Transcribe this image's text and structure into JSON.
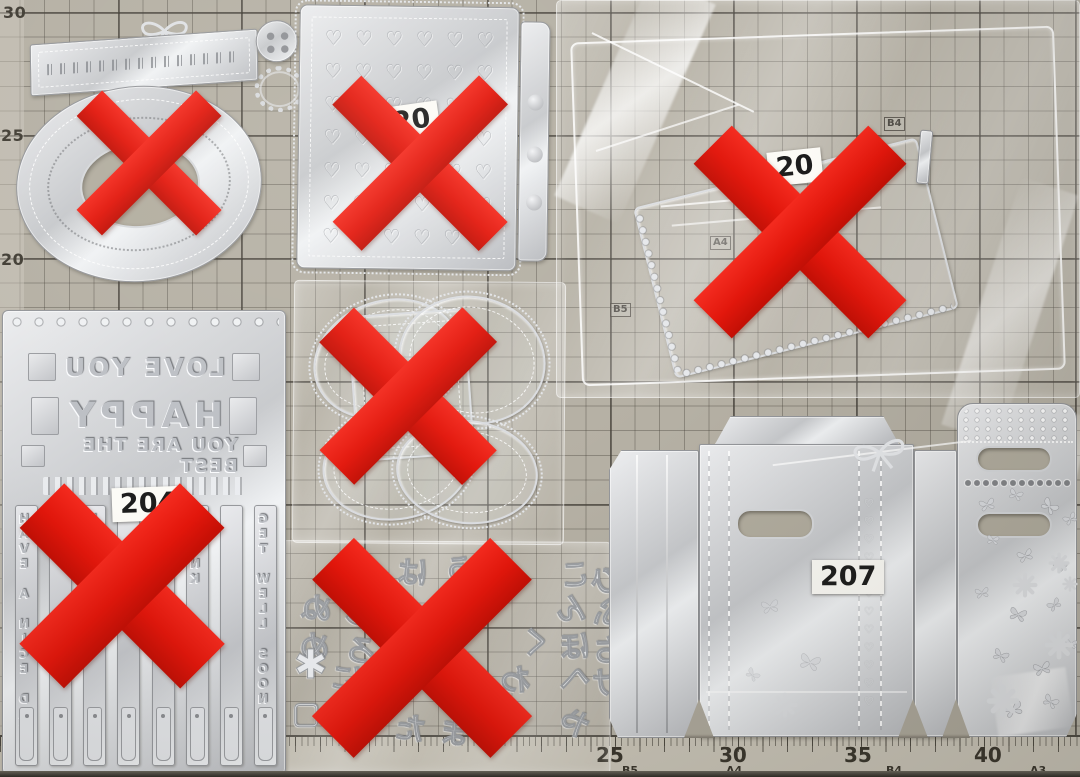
{
  "scene": {
    "type": "photograph",
    "description": "Metal craft cutting dies laid out on a centimeter grid cutting mat. Six die sets are marked out with large red X overlays; the gift-bag die set labelled 207 has no X.",
    "mat_color": "#b5b0a4",
    "red_x_color": "#e2160b",
    "red_x_count": 6
  },
  "mat": {
    "left_scale": [
      "30",
      "25",
      "20"
    ],
    "bottom_scale": [
      "25",
      "30",
      "35",
      "40"
    ],
    "size_marks": {
      "b4": "B4",
      "a4": "A4",
      "b5": "B5"
    },
    "bottom_size_marks": [
      "B5",
      "A4",
      "B4",
      "A3"
    ]
  },
  "items": {
    "banner_set": {
      "name": "banner, bow, button and doily die set",
      "crossed": true
    },
    "heart_panel": {
      "label": "20",
      "crossed": true
    },
    "folder_package": {
      "label": "20",
      "crossed": true
    },
    "sentiment_plate": {
      "label": "204",
      "crossed": true,
      "phrases": [
        "LOVE YOU",
        "HAPPY",
        "YOU ARE THE BEST"
      ],
      "banners": [
        "HAVE A NICE DAY",
        "",
        "HAPPY",
        "",
        "BE",
        "THANK",
        "",
        "GET WELL SOON"
      ]
    },
    "frame_set": {
      "name": "scalloped frame dies",
      "crossed": true
    },
    "hiragana_set": {
      "crossed": true,
      "glyphs": [
        "も",
        "は",
        "う",
        "こ",
        "ひ",
        "ぬ",
        "し",
        "り",
        "ん",
        "ふ",
        "め",
        "ろ",
        "く",
        "ほ",
        "ち",
        "に",
        "お",
        "へ",
        "け",
        "さ",
        "た",
        "ま",
        "や",
        "わ"
      ]
    },
    "gift_bag_set": {
      "label": "207",
      "crossed": false,
      "motifs": [
        "bow",
        "butterflies",
        "daisies",
        "hearts",
        "lace"
      ]
    }
  },
  "decor": {
    "heart_glyph": "♡",
    "flower_glyph": "✱",
    "square_glyph": "▢"
  }
}
